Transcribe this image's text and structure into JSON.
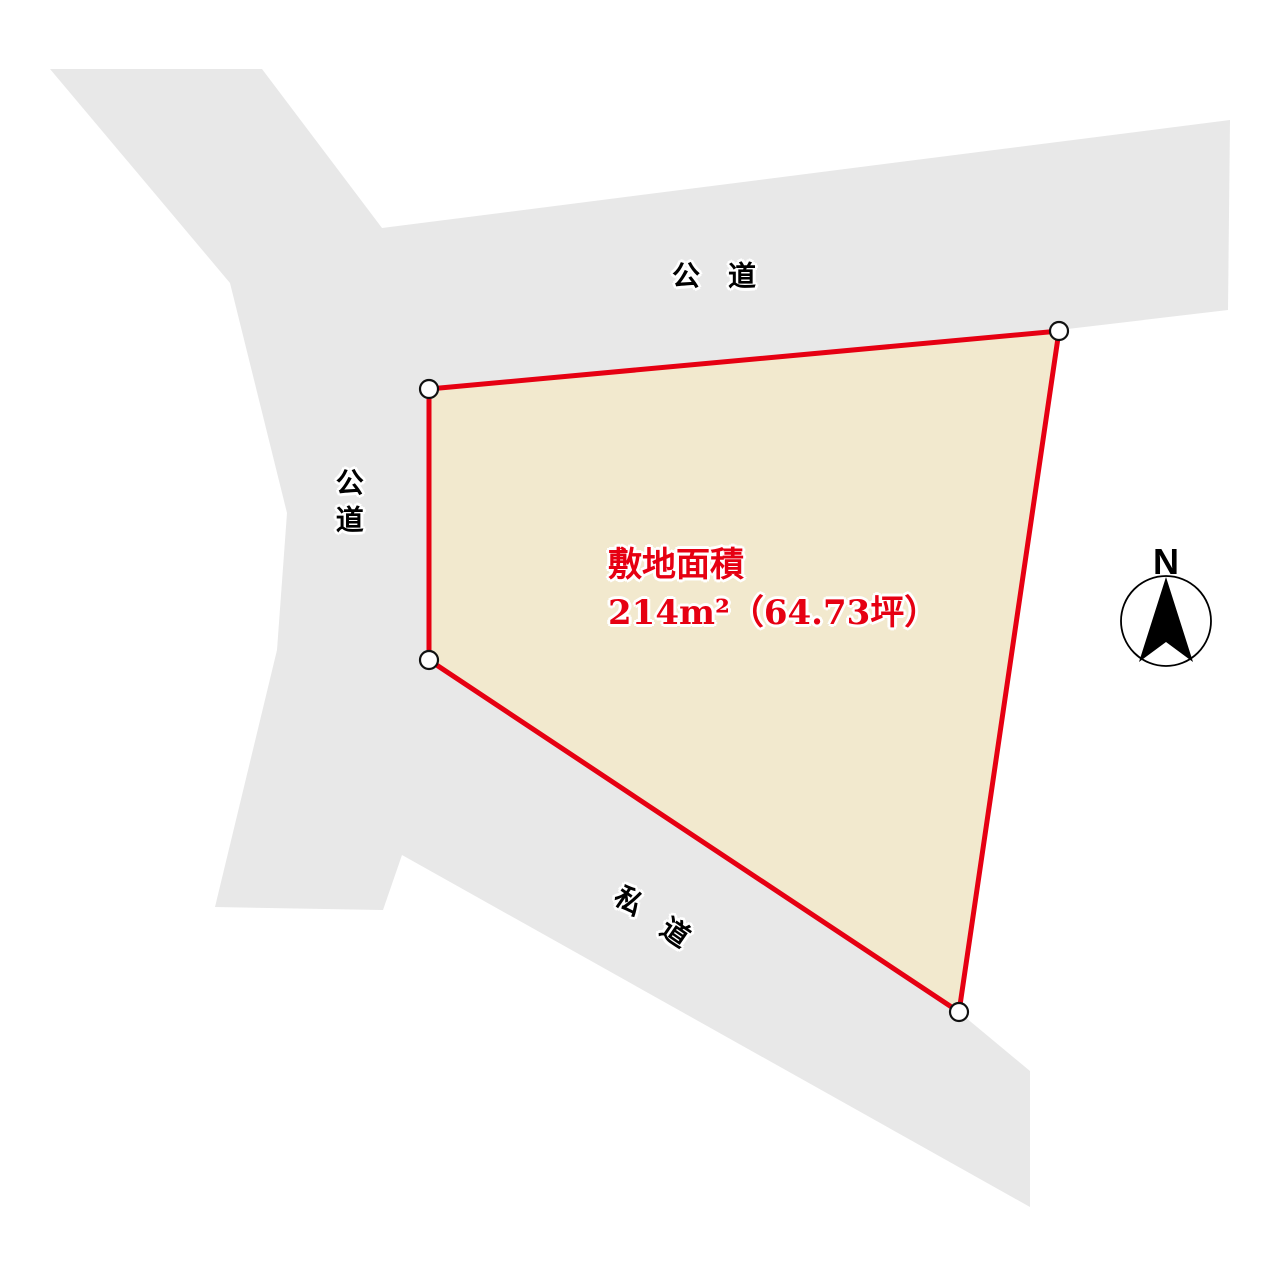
{
  "parcel": {
    "area_heading": "敷地面積",
    "area_value": "214m²（64.73坪）",
    "fill_color": "#F2E9CE",
    "outline_color": "#E60012",
    "vertex_marker_color": "#FFFFFF"
  },
  "roads": {
    "fill_color": "#E8E8E8",
    "top": {
      "label": "公　道",
      "type": "public-road"
    },
    "left": {
      "label": "公道",
      "type": "public-road"
    },
    "bottom": {
      "label": "私　道",
      "type": "private-road"
    }
  },
  "compass": {
    "north_label": "N"
  },
  "text_colors": {
    "road_label": "#000000",
    "area_text": "#E60012",
    "halo": "#FFFFFF"
  }
}
